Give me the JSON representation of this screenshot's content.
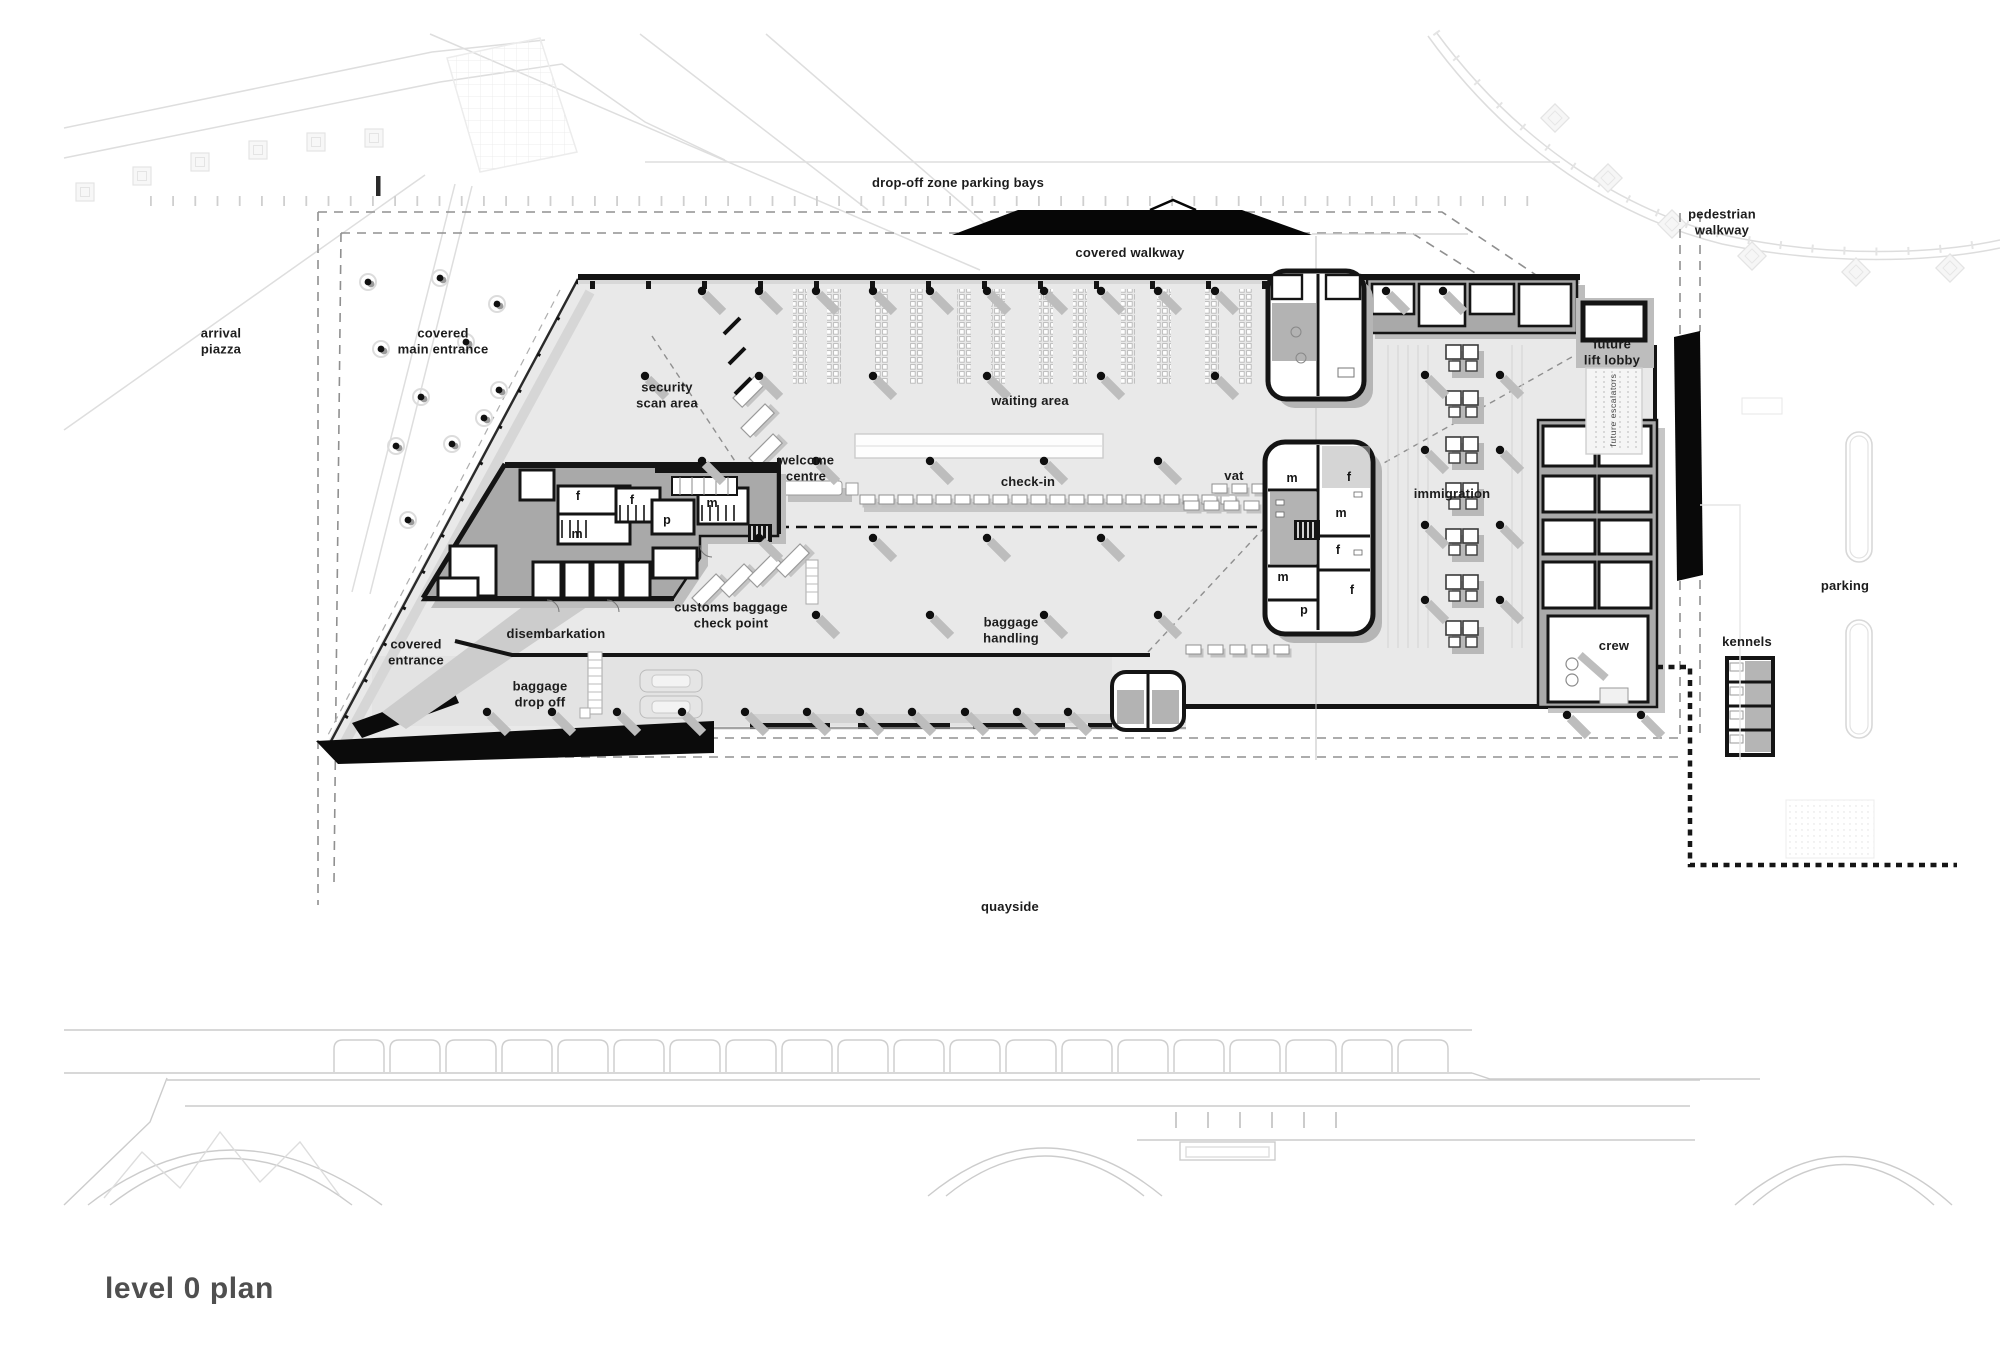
{
  "title": "level 0 plan",
  "colors": {
    "wall": "#141414",
    "floor": "#e9e9e9",
    "service_block": "#a9a9a9",
    "shadow": "#bdbdbd",
    "canopy_black": "#060606",
    "context_line": "#dedede",
    "dashed_boundary": "#909090",
    "label_text": "#1c1c1c",
    "title_text": "#4f4f4f"
  },
  "plan": {
    "labels": {
      "dropoff": "drop-off zone parking bays",
      "pedestrian": "pedestrian\nwalkway",
      "covered_walkway": "covered walkway",
      "arrival_piazza": "arrival\npiazza",
      "covered_main_entrance": "covered\nmain entrance",
      "security_scan": "security\nscan area",
      "waiting_area": "waiting area",
      "welcome_centre": "welcome\ncentre",
      "check_in": "check-in",
      "vat": "vat",
      "immigration": "immigration",
      "future_lift_lobby": "future\nlift lobby",
      "future_escalators": "future escalators",
      "parking": "parking",
      "customs_baggage": "customs baggage\ncheck point",
      "disembarkation": "disembarkation",
      "covered_entrance": "covered\nentrance",
      "crew": "crew",
      "kennels": "kennels",
      "baggage_drop_off": "baggage\ndrop off",
      "baggage_handling": "baggage\nhandling",
      "quayside": "quayside"
    },
    "room_letters": [
      "f",
      "m",
      "f",
      "p",
      "m",
      "m",
      "f",
      "m",
      "f",
      "m",
      "p",
      "f"
    ]
  }
}
